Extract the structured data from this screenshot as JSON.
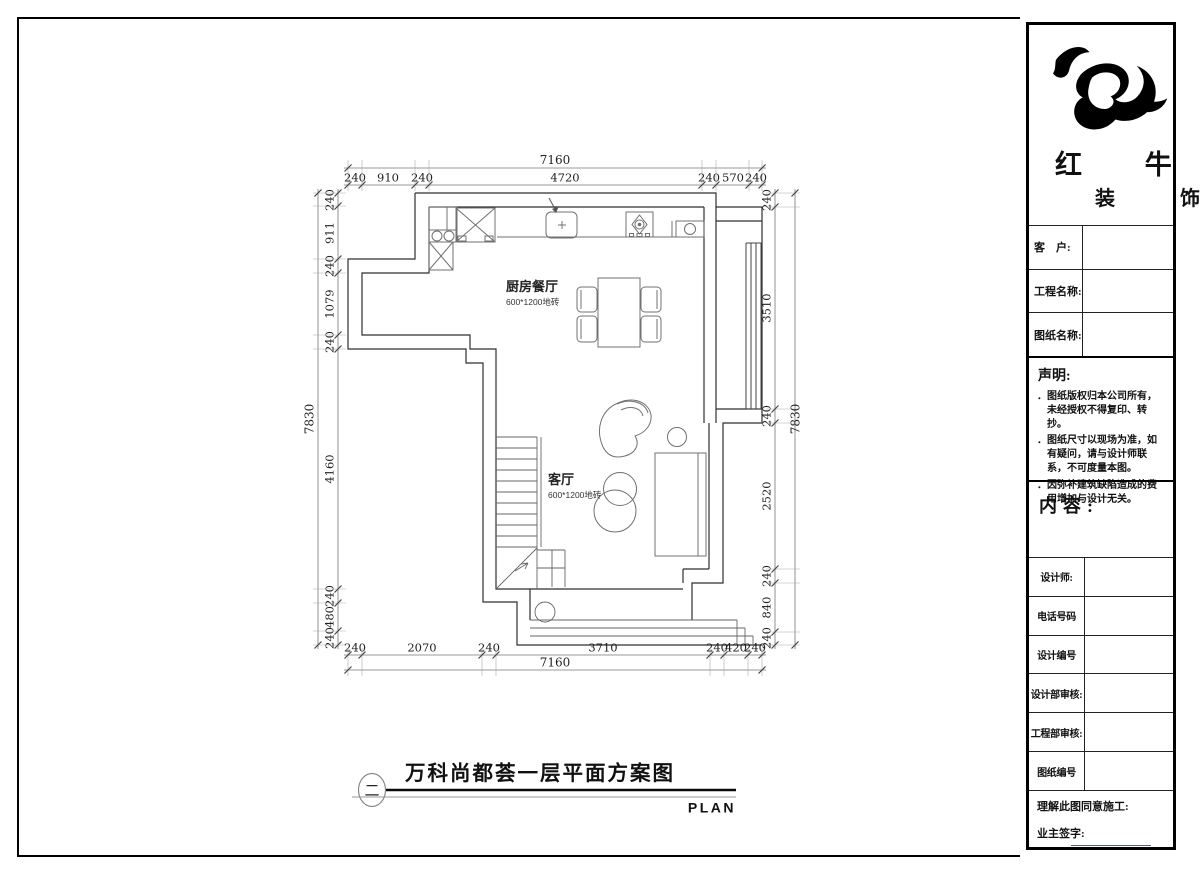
{
  "plan": {
    "rooms": {
      "kitchen_dining": {
        "name": "厨房餐厅",
        "floor_spec": "600*1200地砖"
      },
      "living": {
        "name": "客厅",
        "floor_spec": "600*1200地砖"
      }
    },
    "dims": {
      "top_total": "7160",
      "top": [
        "240",
        "910",
        "240",
        "4720",
        "240",
        "570",
        "240"
      ],
      "bottom": [
        "240",
        "2070",
        "240",
        "3710",
        "240",
        "420",
        "240"
      ],
      "bottom_total": "7160",
      "left_total": "7830",
      "left": [
        "240",
        "911",
        "240",
        "1079",
        "240",
        "4160",
        "240",
        "480",
        "240"
      ],
      "right": [
        "240",
        "3510",
        "240",
        "2520",
        "240",
        "840",
        "240"
      ],
      "right_total": "7830"
    },
    "title": {
      "index_glyph": "二",
      "text": "万科尚都荟一层平面方案图",
      "latin": "PLAN"
    }
  },
  "sidebar": {
    "brand": {
      "line1": "红 牛",
      "line2": "装 饰"
    },
    "fields_top": [
      "客　户:",
      "工程名称:",
      "图纸名称:"
    ],
    "statement": {
      "title": "声明:",
      "marker": "．",
      "items": [
        "图纸版权归本公司所有，未经授权不得复印、转抄。",
        "图纸尺寸以现场为准，如有疑问，请与设计师联系，不可度量本图。",
        "因弥补建筑缺陷造成的费用增加与设计无关。"
      ]
    },
    "content_label": "内容:",
    "fields_mid": [
      "设计师:",
      "电话号码",
      "设计编号",
      "设计部审核:",
      "工程部审核:",
      "图纸编号"
    ],
    "footer": {
      "note": "理解此图同意施工:",
      "sign_label": "业主签字:"
    }
  }
}
